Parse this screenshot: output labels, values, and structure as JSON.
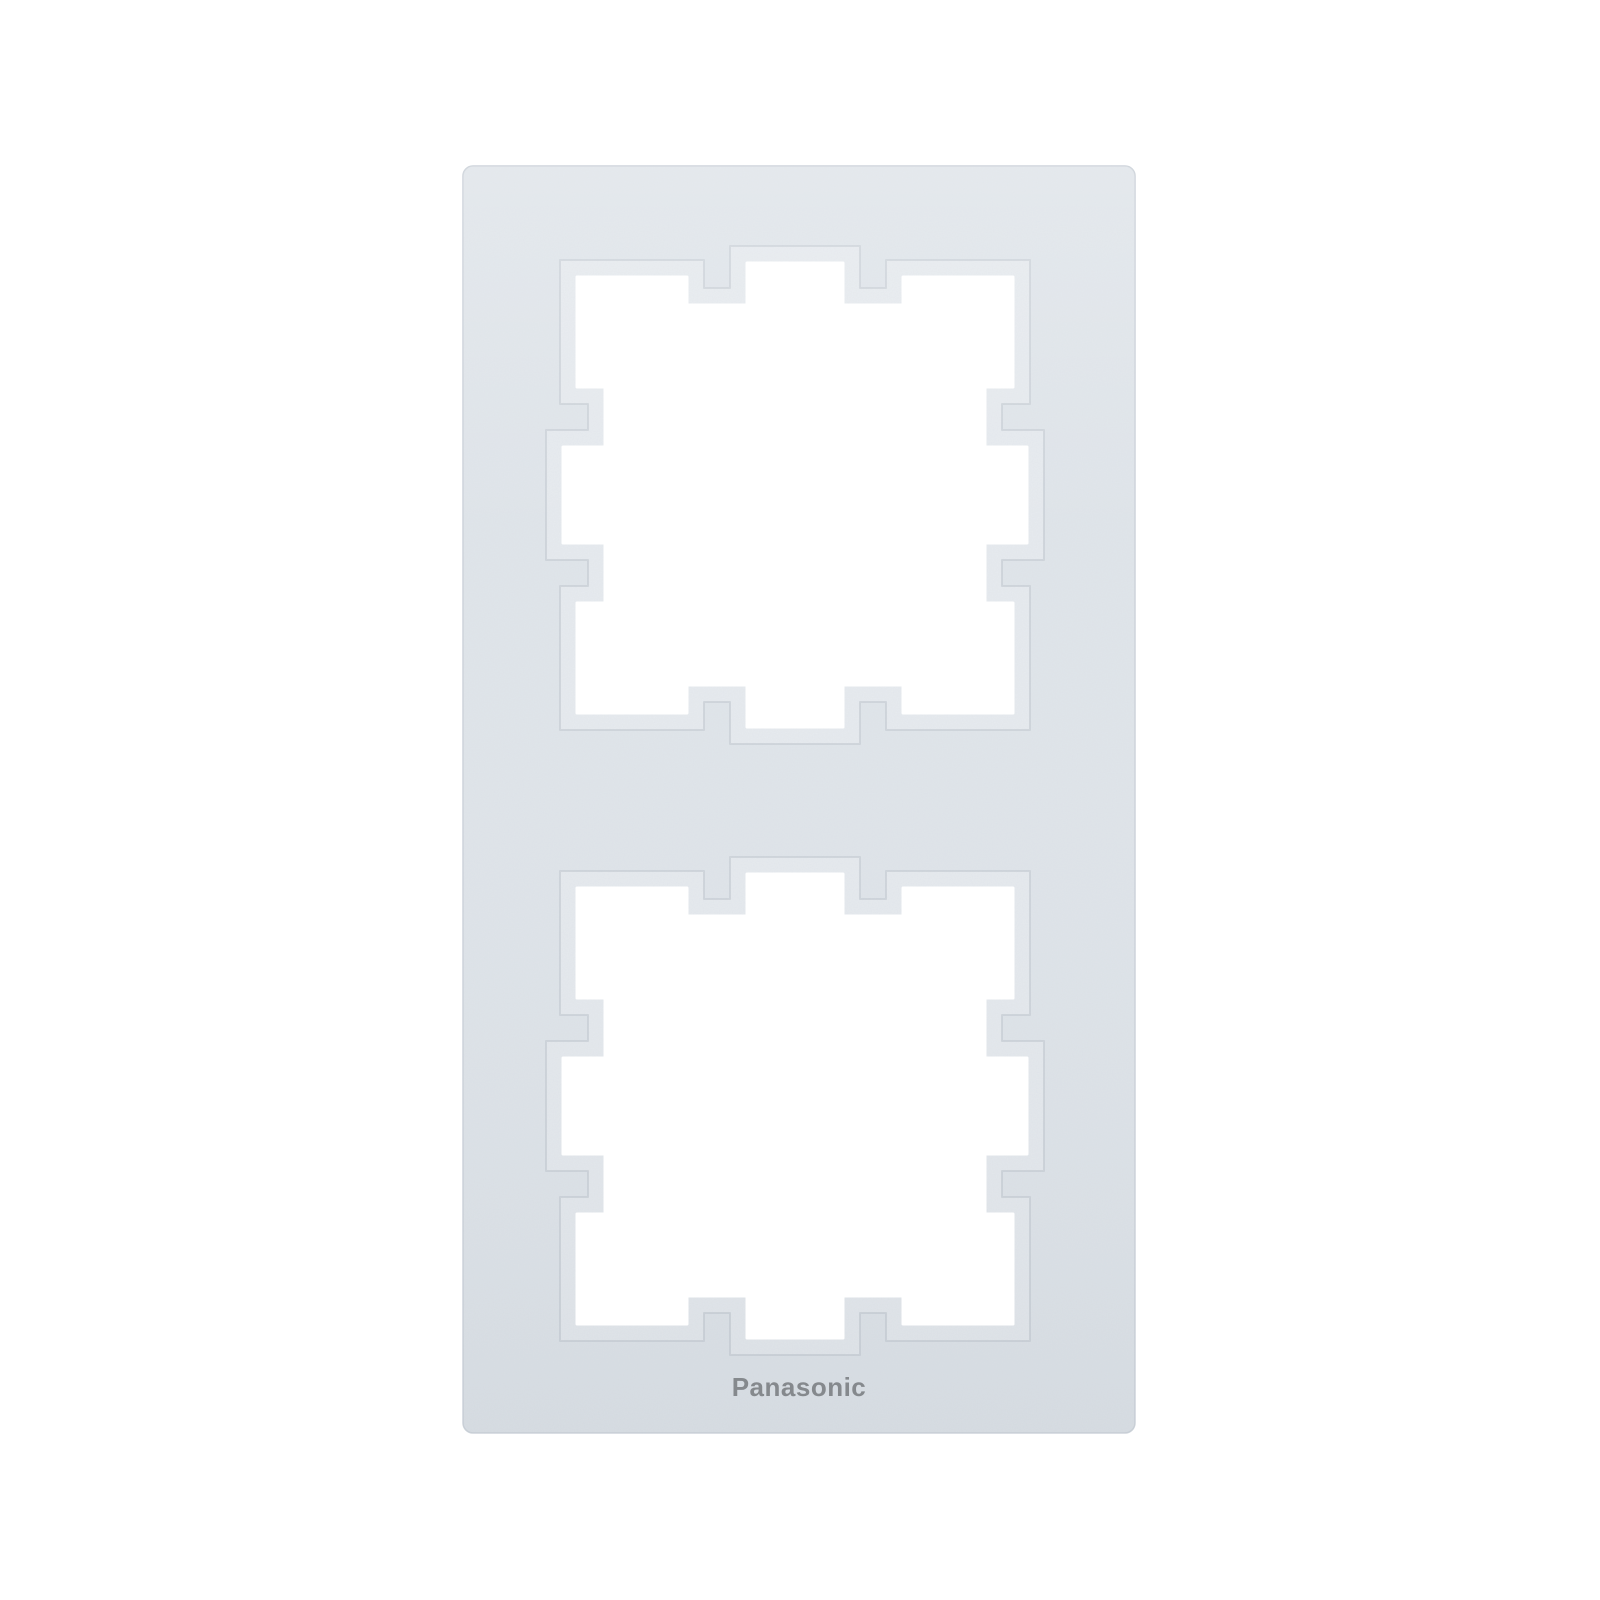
{
  "product": {
    "brand_logo": "Panasonic",
    "description": "Two-gang vertical cover frame (plate) for light switches and sockets, matte silver-white plastic, photographed on a plain white background",
    "openings_count": 2
  },
  "colors": {
    "background": "#ffffff",
    "frame_face": "#e0e5ea",
    "frame_edge": "#ccd2d9",
    "bevel": "#e7ebef",
    "bevel_outline": "#c3cad2",
    "hole": "#ffffff",
    "logo_text": "#85898d"
  }
}
